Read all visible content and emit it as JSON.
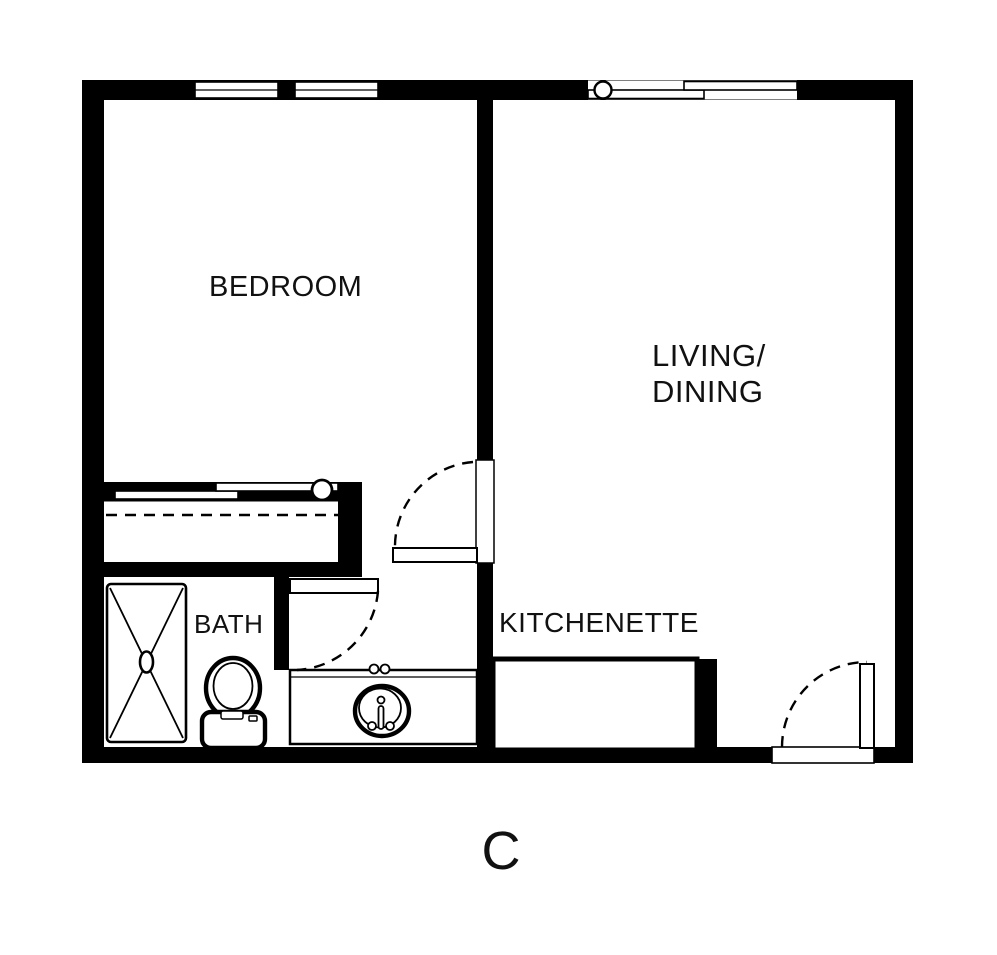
{
  "plan": {
    "title": "apartment floor plan",
    "labels": {
      "bedroom": "BEDROOM",
      "living_line1": "LIVING/",
      "living_line2": "DINING",
      "kitchenette": "KITCHENETTE",
      "bath": "BATH",
      "unit": "C"
    },
    "colors": {
      "walls": "#000000",
      "background": "#ffffff",
      "text": "#111111"
    }
  }
}
